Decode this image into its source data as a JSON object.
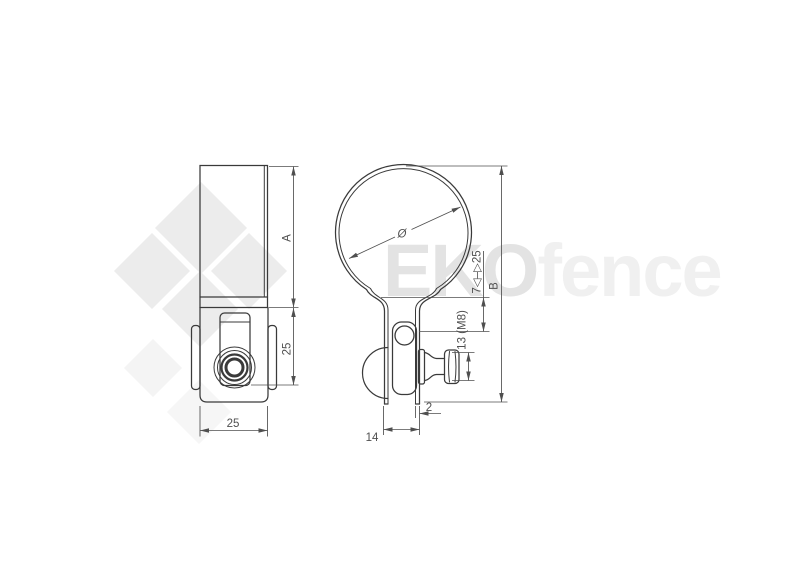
{
  "page": {
    "background": "#ffffff"
  },
  "watermark": {
    "brand_bold": "EKO",
    "brand_light": "fence",
    "diamond_color": "#ececec",
    "diamond_faint_color": "#f4f4f4",
    "bold_text_color": "#e3e3e3",
    "light_text_color": "#f0f0f0"
  },
  "drawing": {
    "line_color": "#3a3a3a",
    "dim_color": "#4f4f4f",
    "dimensions": {
      "side_band_height": "A",
      "side_plate_height": "25",
      "side_width": "25",
      "diameter_symbol": "Ø",
      "adjustment_range": "7◁–▷25",
      "overall_height": "B",
      "bolt_size": "13 (M8)",
      "band_thickness": "2",
      "strap_spacing": "14"
    }
  }
}
